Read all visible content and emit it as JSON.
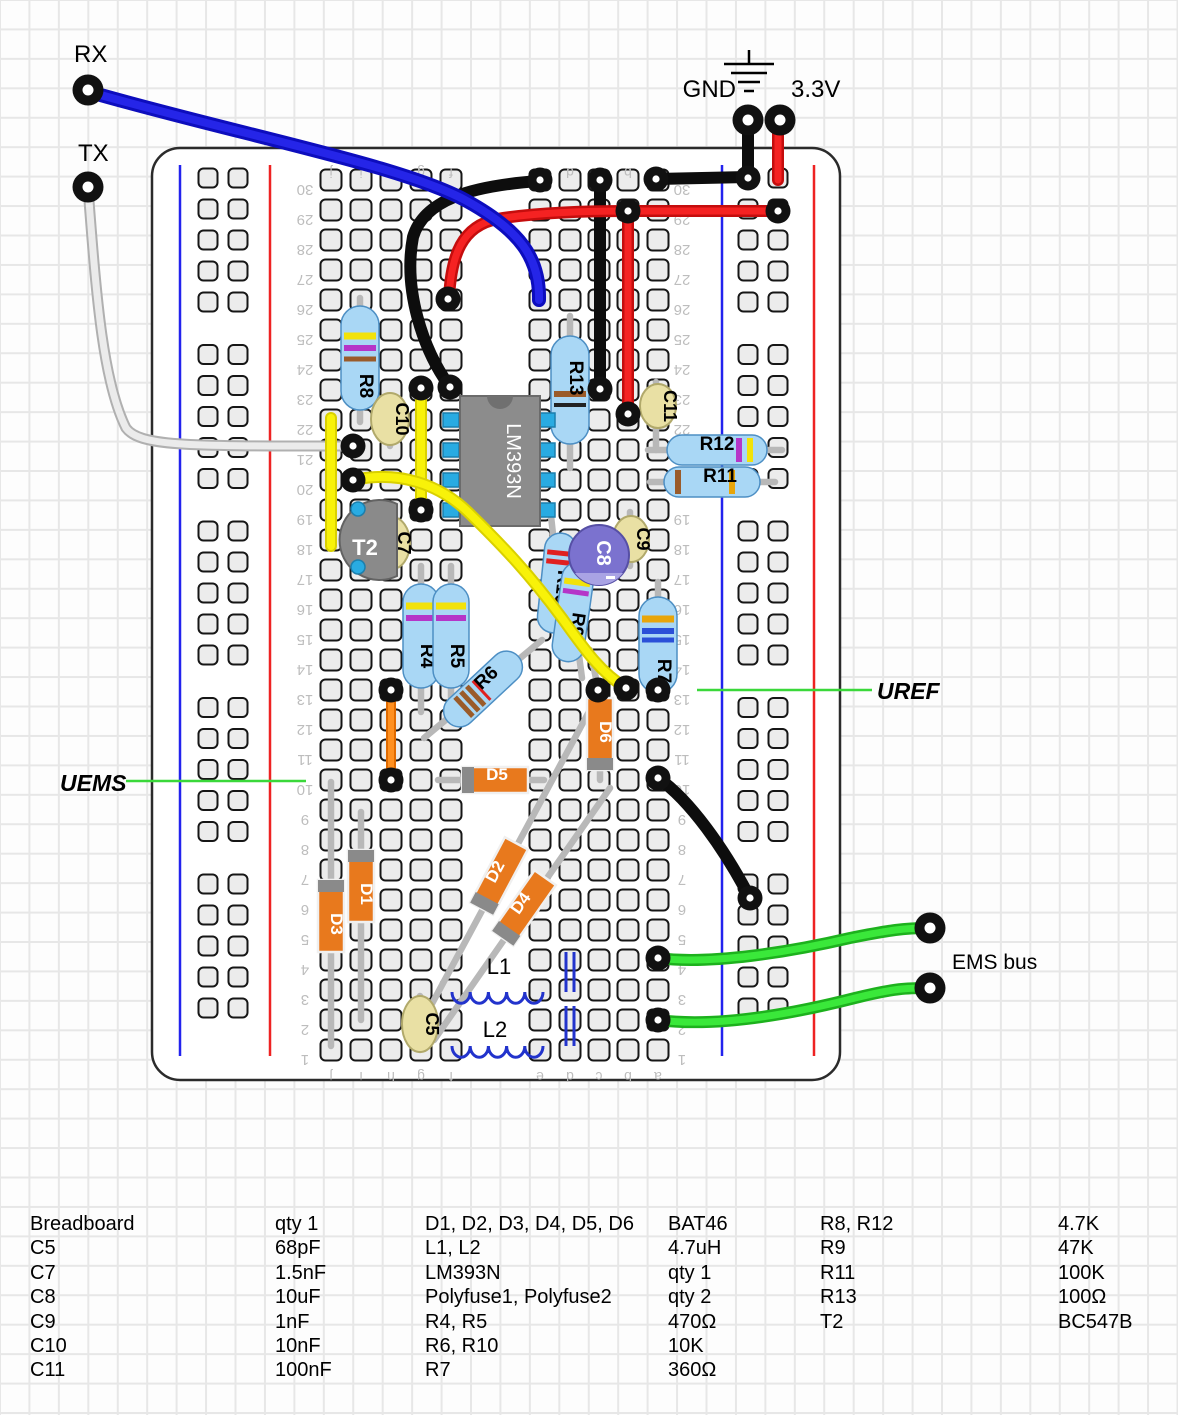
{
  "annotations": {
    "texts": [
      {
        "id": "rx-label",
        "t": "RX",
        "x": 74,
        "y": 62,
        "size": 24,
        "w": "normal",
        "s": "normal",
        "anchor": "start"
      },
      {
        "id": "tx-label",
        "t": "TX",
        "x": 78,
        "y": 161,
        "size": 24,
        "w": "normal",
        "s": "normal",
        "anchor": "start"
      },
      {
        "id": "gnd-label",
        "t": "GND",
        "x": 736,
        "y": 97,
        "size": 24,
        "w": "normal",
        "s": "normal",
        "anchor": "end"
      },
      {
        "id": "v33-label",
        "t": "3.3V",
        "x": 791,
        "y": 97,
        "size": 24,
        "w": "normal",
        "s": "normal",
        "anchor": "start"
      },
      {
        "id": "uref-label",
        "t": "UREF",
        "x": 877,
        "y": 699,
        "size": 23,
        "w": "bold",
        "s": "italic",
        "anchor": "start"
      },
      {
        "id": "uems-label",
        "t": "UEMS",
        "x": 60,
        "y": 791,
        "size": 23,
        "w": "bold",
        "s": "italic",
        "anchor": "start"
      },
      {
        "id": "ems-bus-label",
        "t": "EMS bus",
        "x": 952,
        "y": 969,
        "size": 21,
        "w": "normal",
        "s": "normal",
        "anchor": "start"
      }
    ],
    "pointer_lines": [
      {
        "id": "uems-pointer",
        "x1": 126,
        "y1": 781,
        "x2": 306,
        "y2": 781
      },
      {
        "id": "uref-pointer",
        "x1": 697,
        "y1": 690,
        "x2": 872,
        "y2": 690
      }
    ],
    "pointer_color": "#3ad83a",
    "ground_symbol": {
      "x": 749,
      "stem_y1": 50,
      "stem_y2": 64,
      "bars": [
        [
          64,
          50
        ],
        [
          73,
          36
        ],
        [
          82,
          22
        ],
        [
          91,
          10
        ]
      ]
    }
  },
  "breadboard": {
    "board": {
      "x": 152,
      "y": 148,
      "w": 688,
      "h": 932,
      "rx": 28
    },
    "row_count": 30,
    "row_top_y": 180,
    "row_pitch": 30,
    "column_letters": [
      "j",
      "i",
      "h",
      "g",
      "f",
      "e",
      "d",
      "c",
      "b",
      "a"
    ],
    "column_x": [
      331,
      361,
      391,
      421,
      451,
      540,
      570,
      599,
      628,
      658
    ],
    "letter_rows_y": [
      163,
      1067
    ],
    "number_x": [
      305,
      682
    ],
    "rails": {
      "left": {
        "blue_x": 180,
        "red_x": 270,
        "hole_x": [
          208,
          238
        ]
      },
      "right": {
        "blue_x": 722,
        "red_x": 814,
        "hole_x": [
          748,
          778
        ]
      },
      "line_y1": 165,
      "line_y2": 1056,
      "hole_rows": 25,
      "hole_y0": 178,
      "hole_pitch": 31,
      "group_gap": 21.5
    }
  },
  "leads": [
    [
      360,
      298,
      360,
      422
    ],
    [
      570,
      316,
      570,
      468
    ],
    [
      390,
      398,
      390,
      446
    ],
    [
      656,
      382,
      656,
      450
    ],
    [
      392,
      520,
      392,
      568
    ],
    [
      630,
      512,
      630,
      566
    ],
    [
      420,
      996,
      420,
      1050
    ],
    [
      648,
      450,
      782,
      450
    ],
    [
      650,
      482,
      775,
      482
    ],
    [
      421,
      566,
      421,
      712
    ],
    [
      451,
      566,
      451,
      712
    ],
    [
      551,
      516,
      566,
      652
    ],
    [
      565,
      548,
      582,
      678
    ],
    [
      542,
      640,
      424,
      738
    ],
    [
      658,
      582,
      658,
      692
    ],
    [
      600,
      688,
      600,
      780
    ],
    [
      438,
      780,
      544,
      780
    ],
    [
      361,
      812,
      361,
      1020
    ],
    [
      331,
      782,
      331,
      1046
    ],
    [
      592,
      706,
      420,
      1026
    ],
    [
      610,
      788,
      434,
      1040
    ],
    [
      590,
      650,
      598,
      688
    ]
  ],
  "resistors": [
    {
      "label": "R8",
      "cx": 360,
      "cy": 358,
      "len": 104,
      "w": 38,
      "rot": 0,
      "labelOff": 22,
      "labelRot": 90,
      "bands": [
        [
          -22,
          "#f2e20a",
          7
        ],
        [
          -10,
          "#b535c8",
          6
        ],
        [
          1,
          "#9a5b2a",
          5
        ]
      ]
    },
    {
      "label": "R13",
      "cx": 570,
      "cy": 390,
      "len": 108,
      "w": 38,
      "rot": 0,
      "labelOff": -18,
      "labelRot": 90,
      "bands": [
        [
          4,
          "#9a5b2a",
          6
        ],
        [
          15,
          "#222222",
          4
        ]
      ]
    },
    {
      "label": "R4",
      "cx": 421,
      "cy": 636,
      "len": 104,
      "w": 36,
      "rot": 0,
      "labelOff": 14,
      "labelRot": 90,
      "bands": [
        [
          -30,
          "#f2e20a",
          7
        ],
        [
          -18,
          "#b535c8",
          6
        ]
      ]
    },
    {
      "label": "R5",
      "cx": 451,
      "cy": 636,
      "len": 104,
      "w": 36,
      "rot": 0,
      "labelOff": 14,
      "labelRot": 90,
      "bands": [
        [
          -30,
          "#f2e20a",
          7
        ],
        [
          -18,
          "#b535c8",
          6
        ]
      ]
    },
    {
      "label": "R7",
      "cx": 658,
      "cy": 645,
      "len": 96,
      "w": 38,
      "rot": 0,
      "labelOff": 20,
      "labelRot": 90,
      "bands": [
        [
          -26,
          "#e8a50a",
          7
        ],
        [
          -14,
          "#2b50d8",
          6
        ],
        [
          -5,
          "#2b50d8",
          5
        ]
      ]
    },
    {
      "label": "R12",
      "cx": 717,
      "cy": 450,
      "len": 100,
      "w": 30,
      "rot": -90,
      "labelOff": -6,
      "labelRot": 90,
      "bands": [
        [
          22,
          "#b535c8",
          6
        ],
        [
          33,
          "#f2e20a",
          6
        ]
      ]
    },
    {
      "label": "R11",
      "cx": 712,
      "cy": 482,
      "len": 96,
      "w": 30,
      "rot": -90,
      "labelOff": 2,
      "labelRot": 90,
      "bands": [
        [
          -34,
          "#9a5b2a",
          6
        ],
        [
          20,
          "#e8a50a",
          6
        ]
      ]
    },
    {
      "label": "R10",
      "cx": 557,
      "cy": 583,
      "len": 100,
      "w": 32,
      "rot": 6,
      "labelOff": -2,
      "labelRot": 90,
      "bands": [
        [
          -30,
          "#e02020",
          5
        ],
        [
          -21,
          "#e02020",
          5
        ],
        [
          18,
          "#9a5b2a",
          5
        ]
      ]
    },
    {
      "label": "R9",
      "cx": 573,
      "cy": 612,
      "len": 100,
      "w": 32,
      "rot": 8,
      "labelOff": 6,
      "labelRot": 90,
      "bands": [
        [
          -30,
          "#f2e20a",
          6
        ],
        [
          -20,
          "#b535c8",
          5
        ]
      ]
    },
    {
      "label": "R6",
      "cx": 483,
      "cy": 689,
      "len": 96,
      "w": 32,
      "rot": 47,
      "labelOff": -16,
      "labelRot": -90,
      "bands": [
        [
          10,
          "#9a5b2a",
          5
        ],
        [
          18,
          "#9a5b2a",
          5
        ],
        [
          26,
          "#9a5b2a",
          5
        ],
        [
          2,
          "#e02020",
          3
        ]
      ]
    }
  ],
  "disc_caps": [
    {
      "label": "C10",
      "cx": 390,
      "cy": 419,
      "rx": 19,
      "ry": 26
    },
    {
      "label": "C7",
      "cx": 392,
      "cy": 543,
      "rx": 18,
      "ry": 26
    },
    {
      "label": "C9",
      "cx": 631,
      "cy": 539,
      "rx": 18,
      "ry": 23
    },
    {
      "label": "C11",
      "cx": 658,
      "cy": 406,
      "rx": 18,
      "ry": 22
    },
    {
      "label": "C5",
      "cx": 420,
      "cy": 1024,
      "rx": 18,
      "ry": 28
    }
  ],
  "electro_cap": {
    "label": "C8",
    "cx": 599,
    "cy": 555,
    "r": 30,
    "minus": "-"
  },
  "diodes": [
    {
      "label": "D1",
      "cx": 361,
      "cy": 886,
      "len": 72,
      "w": 26,
      "rot": 0,
      "band": "top",
      "labelRot": 90
    },
    {
      "label": "D3",
      "cx": 331,
      "cy": 916,
      "len": 72,
      "w": 26,
      "rot": 0,
      "band": "top",
      "labelRot": 90
    },
    {
      "label": "D6",
      "cx": 600,
      "cy": 734,
      "len": 72,
      "w": 26,
      "rot": 0,
      "band": "bottom",
      "labelRot": 90
    },
    {
      "label": "D5",
      "cx": 495,
      "cy": 780,
      "len": 66,
      "w": 26,
      "rot": 90,
      "band": "bottom",
      "labelRot": -90
    },
    {
      "label": "D2",
      "cx": 499,
      "cy": 876,
      "len": 74,
      "w": 26,
      "rot": 28,
      "band": "bottom",
      "labelRot": -90
    },
    {
      "label": "D4",
      "cx": 524,
      "cy": 908,
      "len": 74,
      "w": 26,
      "rot": 35,
      "band": "bottom",
      "labelRot": -90
    }
  ],
  "ic": {
    "label": "LM393N",
    "x": 460,
    "y": 396,
    "w": 80,
    "h": 130,
    "pin_y": [
      420,
      450,
      480,
      510
    ],
    "pin_lx": 451,
    "pin_rx": 547
  },
  "transistor": {
    "label": "T2",
    "flat_x": 397,
    "y1": 504,
    "y2": 576,
    "r": 40,
    "pins": [
      [
        358,
        509
      ],
      [
        358,
        567
      ]
    ],
    "label_x": 365,
    "label_y": 555
  },
  "inductors": [
    {
      "label": "L1",
      "x0": 452,
      "y": 992,
      "bumps": 5,
      "bw": 18.2,
      "bars_x": [
        566,
        574
      ],
      "bar_y1": 952,
      "label_x": 487,
      "label_y": 974
    },
    {
      "label": "L2",
      "x0": 452,
      "y": 1046,
      "bumps": 5,
      "bw": 18.2,
      "bars_x": [
        566,
        574
      ],
      "bar_y1": 1006,
      "label_x": 483,
      "label_y": 1037
    }
  ],
  "wires": [
    {
      "id": "gnd-jumper-top",
      "color": "black",
      "d": "M748,121 L748,177"
    },
    {
      "id": "gnd-rail-jumper",
      "color": "black",
      "d": "M656,179 L748,177"
    },
    {
      "id": "black-curve-wire",
      "color": "black",
      "d": "M539,181 C470,186 424,200 413,237 C403,290 423,350 450,387"
    },
    {
      "id": "black-column-wire",
      "color": "black",
      "d": "M600,180 L600,389"
    },
    {
      "id": "black-diagonal-wire",
      "color": "black",
      "d": "M658,778 C690,800 725,850 750,898"
    },
    {
      "id": "v33-jumper",
      "color": "red",
      "d": "M778,121 L778,180"
    },
    {
      "id": "red-rail-jumper",
      "color": "red",
      "d": "M628,211 L778,211"
    },
    {
      "id": "red-column-wire",
      "color": "red",
      "d": "M628,211 L628,414"
    },
    {
      "id": "red-curve-wire",
      "color": "red",
      "d": "M449,299 C451,255 462,226 497,219 C540,212 590,211 627,211"
    },
    {
      "id": "rx-wire",
      "color": "blue",
      "d": "M90,92 C240,135 400,165 465,200 C520,230 540,258 539,300"
    },
    {
      "id": "tx-wire",
      "color": "white",
      "d": "M88,188 C96,290 102,380 126,428 C140,447 190,446 351,446"
    },
    {
      "id": "yellow-wire-1",
      "color": "yellow",
      "d": "M331,418 L331,546"
    },
    {
      "id": "yellow-wire-2",
      "color": "yellow",
      "d": "M421,388 L421,510"
    },
    {
      "id": "yellow-wire-3",
      "color": "yellow",
      "d": "M353,480 C400,470 440,485 468,512 C505,548 530,575 562,618 C585,650 600,672 626,688"
    },
    {
      "id": "orange-wire",
      "color": "orange",
      "d": "M391,690 L391,780"
    },
    {
      "id": "ems-wire-1",
      "color": "green",
      "d": "M658,958 C710,965 790,952 850,938 C890,930 905,928 928,928"
    },
    {
      "id": "ems-wire-2",
      "color": "green",
      "d": "M658,1020 C720,1028 800,1012 855,998 C895,988 908,988 928,988"
    }
  ],
  "wire_styles": {
    "black": {
      "under": "#0d0d0d",
      "uw": 12,
      "over": null,
      "ow": 0
    },
    "red": {
      "under": "#c50d0d",
      "uw": 12,
      "over": "#f52222",
      "ow": 7
    },
    "blue": {
      "under": "#0d0dbd",
      "uw": 14,
      "over": "#2525e8",
      "ow": 8
    },
    "white": {
      "under": "#b0b0b0",
      "uw": 11,
      "over": "#ebebeb",
      "ow": 7
    },
    "yellow": {
      "under": "#d9d000",
      "uw": 12,
      "over": "#f8f209",
      "ow": 8
    },
    "orange": {
      "under": "#e06a00",
      "uw": 10,
      "over": "#ff9020",
      "ow": 6
    },
    "green": {
      "under": "#1db11d",
      "uw": 12,
      "over": "#3ae83a",
      "ow": 7
    }
  },
  "dots": [
    [
      540,
      180
    ],
    [
      450,
      387
    ],
    [
      600,
      180
    ],
    [
      600,
      389
    ],
    [
      748,
      178
    ],
    [
      656,
      179
    ],
    [
      448,
      299
    ],
    [
      628,
      211
    ],
    [
      628,
      414
    ],
    [
      778,
      211
    ],
    [
      353,
      446
    ],
    [
      353,
      480
    ],
    [
      626,
      688
    ],
    [
      421,
      388
    ],
    [
      421,
      510
    ],
    [
      391,
      690
    ],
    [
      391,
      780
    ],
    [
      598,
      690
    ],
    [
      658,
      690
    ],
    [
      658,
      778
    ],
    [
      750,
      898
    ],
    [
      658,
      958
    ],
    [
      658,
      1020
    ]
  ],
  "posts": [
    {
      "id": "rx-terminal",
      "x": 88,
      "y": 90
    },
    {
      "id": "tx-terminal",
      "x": 88,
      "y": 187
    },
    {
      "id": "gnd-terminal",
      "x": 748,
      "y": 120
    },
    {
      "id": "v33-terminal",
      "x": 780,
      "y": 120
    },
    {
      "id": "ems-terminal-1",
      "x": 930,
      "y": 928
    },
    {
      "id": "ems-terminal-2",
      "x": 930,
      "y": 988
    }
  ],
  "parts_list": {
    "columns": [
      {
        "x": 30,
        "value_offset": 245,
        "entries": [
          {
            "name": "Breadboard",
            "value": "qty 1"
          },
          {
            "name": "C5",
            "value": "68pF"
          },
          {
            "name": "C7",
            "value": "1.5nF"
          },
          {
            "name": "C8",
            "value": "10uF"
          },
          {
            "name": "C9",
            "value": "1nF"
          },
          {
            "name": "C10",
            "value": "10nF"
          },
          {
            "name": "C11",
            "value": "100nF"
          }
        ]
      },
      {
        "x": 425,
        "value_offset": 243,
        "entries": [
          {
            "name": "D1, D2, D3, D4, D5, D6",
            "value": "BAT46"
          },
          {
            "name": "L1, L2",
            "value": "4.7uH"
          },
          {
            "name": "LM393N",
            "value": "qty 1"
          },
          {
            "name": "Polyfuse1, Polyfuse2",
            "value": "qty 2"
          },
          {
            "name": "R4, R5",
            "value": "470Ω"
          },
          {
            "name": "R6, R10",
            "value": "10K"
          },
          {
            "name": "R7",
            "value": "360Ω"
          }
        ]
      },
      {
        "x": 820,
        "value_offset": 238,
        "entries": [
          {
            "name": "R8, R12",
            "value": "4.7K"
          },
          {
            "name": "R9",
            "value": "47K"
          },
          {
            "name": "R11",
            "value": "100K"
          },
          {
            "name": "R13",
            "value": "100Ω"
          },
          {
            "name": "T2",
            "value": "BC547B"
          }
        ]
      }
    ]
  },
  "palette": {
    "resistor_fill": "#a9d7f5",
    "resistor_stroke": "#4d8fc4",
    "diode_fill": "#e8791d",
    "diode_stroke": "#f0f0f0",
    "diode_band": "#8a8a8a",
    "cap_fill": "#e9e0a4",
    "cap_stroke": "#b1a96b",
    "electro_fill": "#7b72cf",
    "electro_stroke": "#564fa5",
    "electro_band": "#a9a3e4",
    "ic_fill": "#8c8c8c",
    "ic_stroke": "#6b6b6b",
    "ic_notch": "#707070",
    "pin_fill": "#29abe2",
    "pin_stroke": "#1c7fad",
    "lead": "#b8b8b8",
    "hole_fill": "#ececec",
    "hole_stroke": "#161616",
    "rail_blue": "#2222ee",
    "rail_red": "#ee2222",
    "board_stroke": "#2b2b2b",
    "gutter_text": "#bdbdbd"
  }
}
